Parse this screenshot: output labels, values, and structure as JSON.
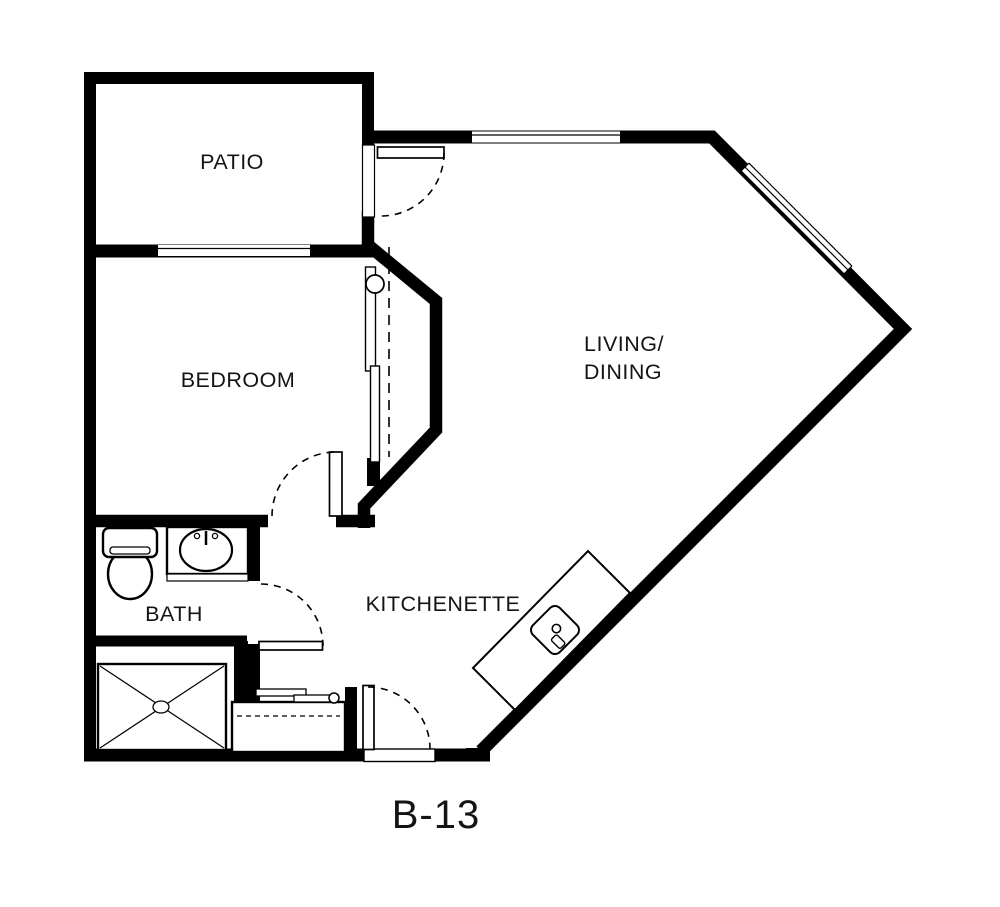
{
  "plan": {
    "title": "B-13",
    "rooms": {
      "patio": "PATIO",
      "bedroom": "BEDROOM",
      "living_dining_line1": "LIVING/",
      "living_dining_line2": "DINING",
      "bath": "BATH",
      "kitchenette": "KITCHENETTE"
    },
    "colors": {
      "wall": "#000000",
      "floor": "#ffffff",
      "label_text": "#141414"
    }
  }
}
